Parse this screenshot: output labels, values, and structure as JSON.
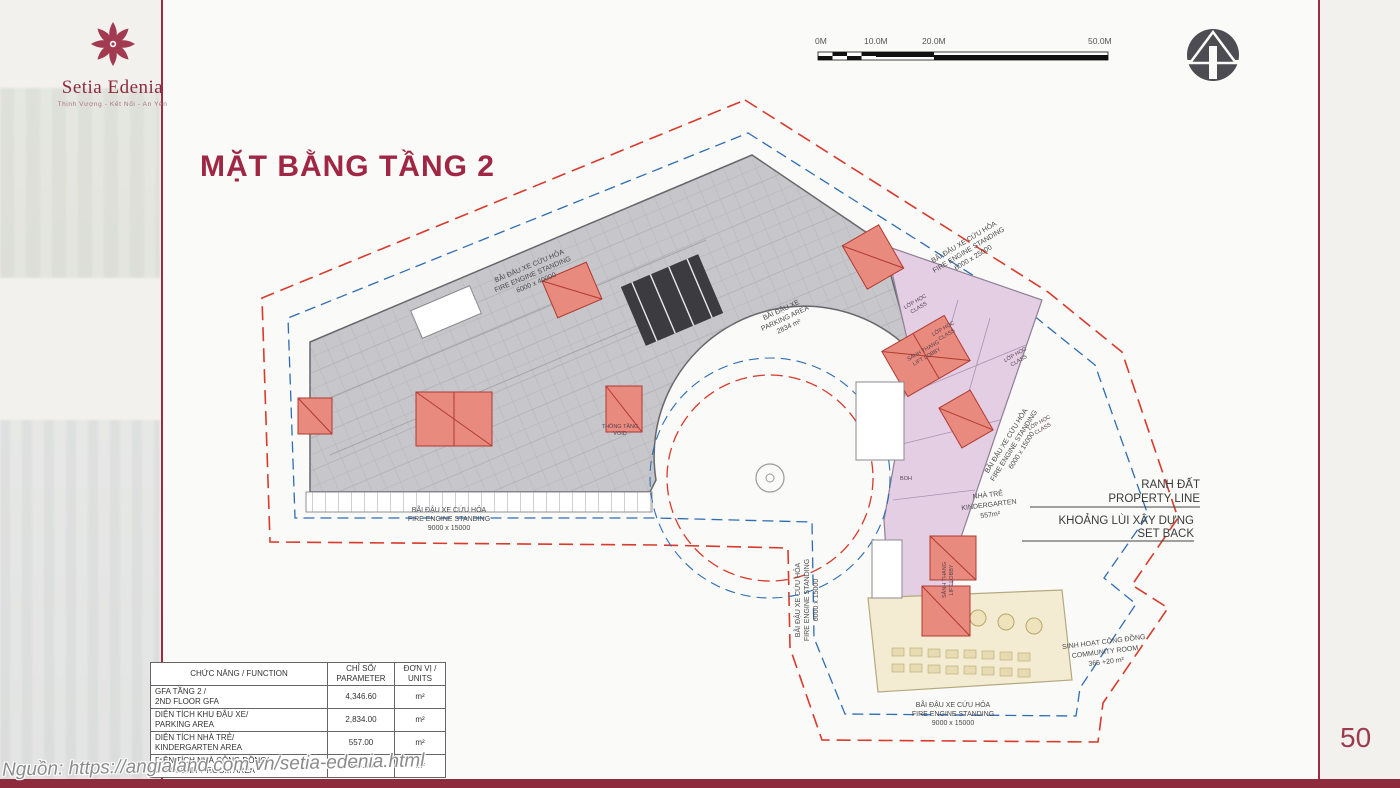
{
  "brand": {
    "name": "Setia Edenia",
    "tagline": "Thịnh Vượng - Kết Nối - An Yên"
  },
  "page": {
    "title": "MẶT BẰNG TẦNG 2",
    "number": "50",
    "source": "Nguồn: https://angialand.com.vn/setia-edenia.html"
  },
  "scalebar": {
    "labels": [
      "0M",
      "10.0M",
      "20.0M",
      "50.0M"
    ]
  },
  "plan": {
    "fire_west": [
      "BÃI ĐẬU XE CỨU HỎA",
      "FIRE ENGINE STANDING",
      "6000 x 40000"
    ],
    "parking": [
      "BÃI ĐẬU XE",
      "PARKING AREA",
      "2834 m²"
    ],
    "fire_northeast": [
      "BÃI ĐẬU XE CỨU HỎA",
      "FIRE ENGINE STANDING",
      "6000 x 25000"
    ],
    "fire_east": [
      "BÃI ĐẬU XE CỨU HỎA",
      "FIRE ENGINE STANDING",
      "6000 x 15000"
    ],
    "fire_south_west": [
      "BÃI ĐẬU XE CỨU HỎA",
      "FIRE ENGINE STANDING",
      "9000 x 15000"
    ],
    "fire_south_mid": [
      "BÃI ĐẬU XE CỨU HỎA",
      "FIRE ENGINE STANDING",
      "6000 x 15000"
    ],
    "fire_south_east": [
      "BÃI ĐẬU XE CỨU HỎA",
      "FIRE ENGINE STANDING",
      "9000 x 15000"
    ],
    "kindergarten": [
      "NHÀ TRẺ",
      "KINDERGARTEN",
      "557m²"
    ],
    "community": [
      "SINH HOẠT CỘNG ĐỒNG",
      "COMMUNITY ROOM",
      "365 +20 m²"
    ],
    "class_room": [
      "LỚP HỌC",
      "CLASS"
    ],
    "lift_lobby": [
      "SẢNH THANG",
      "LIFT LOBBY"
    ],
    "void_room": [
      "THÔNG TẦNG",
      "VOID"
    ],
    "boh": "BOH",
    "legend": {
      "property_vi": "RANH ĐẤT",
      "property_en": "PROPERTY LINE",
      "setback_vi": "KHOẢNG LÙI XÂY DỰNG",
      "setback_en": "SET BACK"
    }
  },
  "table": {
    "headers": [
      "CHỨC NĂNG / FUNCTION",
      "CHỈ SỐ/\nPARAMETER",
      "ĐƠN VỊ /\nUNITS"
    ],
    "rows": [
      {
        "function": "GFA TẦNG 2 /\n2ND FLOOR GFA",
        "value": "4,346.60",
        "unit": "m²"
      },
      {
        "function": "DIỆN TÍCH KHU ĐẬU XE/\nPARKING AREA",
        "value": "2,834.00",
        "unit": "m²"
      },
      {
        "function": "DIỆN TÍCH NHÀ TRẺ/\nKINDERGARTEN AREA",
        "value": "557.00",
        "unit": "m²"
      },
      {
        "function": "DIỆN TÍCH NHÀ CỘNG ĐỒNG/\nCOMMUNITY ROOM AREA",
        "value": "385.00",
        "unit": "m²"
      }
    ]
  },
  "colors": {
    "accent": "#9c2743",
    "parking_fill": "#c7c7cb",
    "kindergarten_fill": "#e3cee4",
    "community_fill": "#f4ecd2",
    "core_fill": "#e98a7e",
    "property_line": "#d93a2b",
    "setback_line": "#2e6db4"
  }
}
